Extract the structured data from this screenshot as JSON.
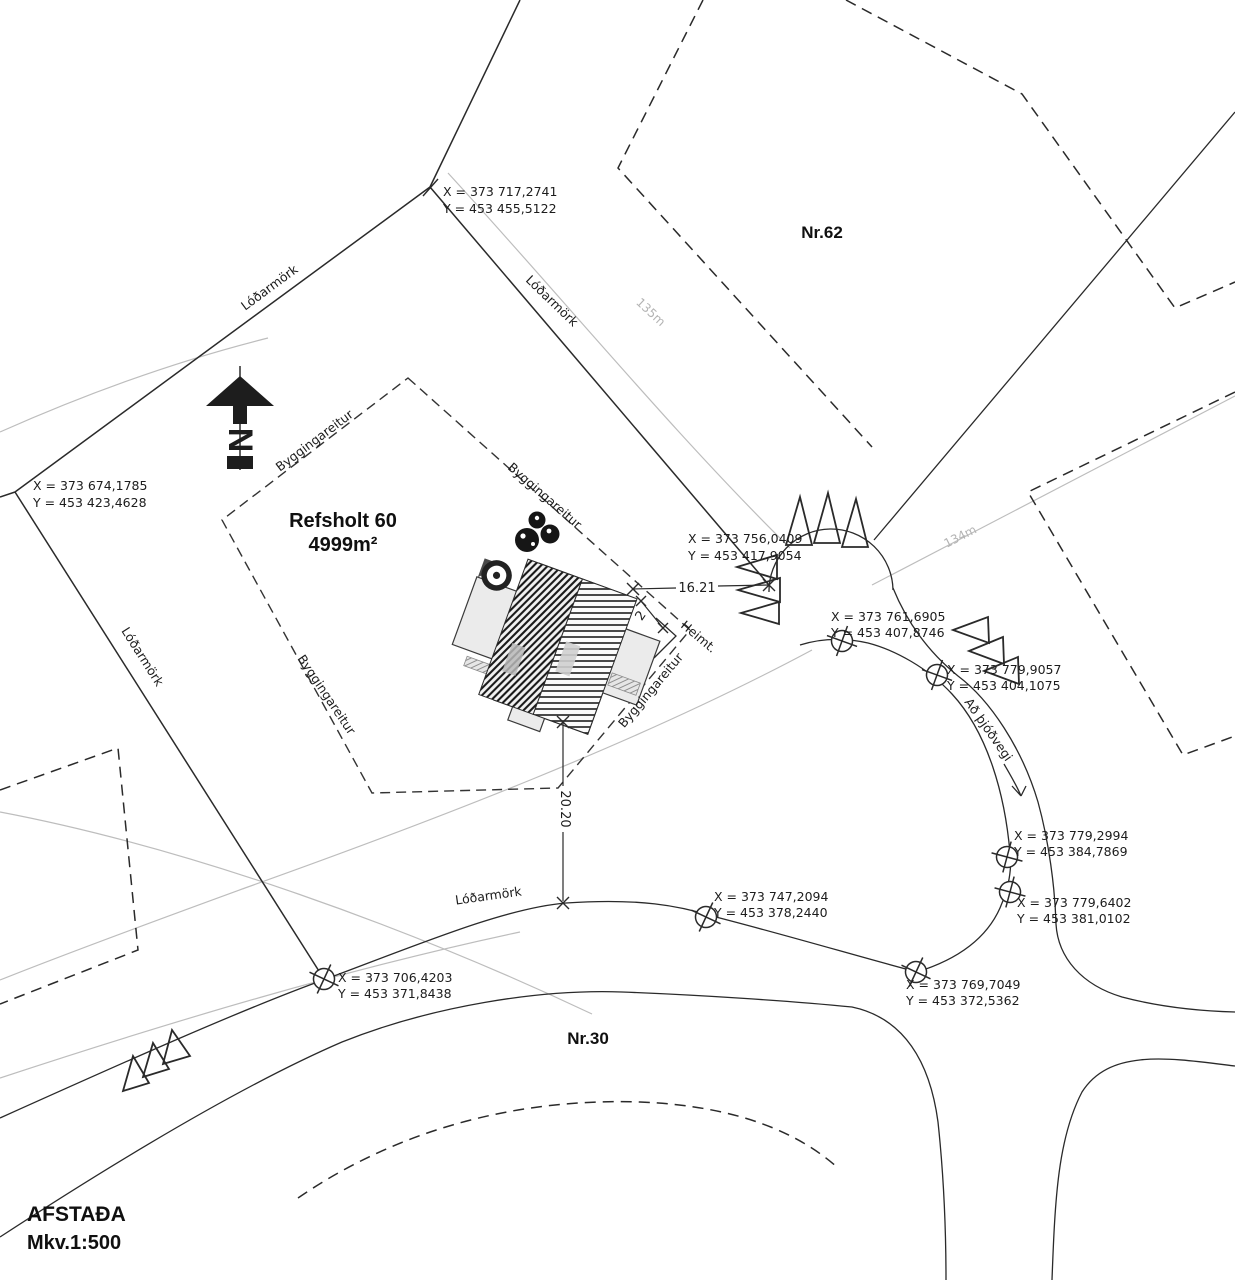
{
  "drawing": {
    "title": "AFSTAÐA",
    "scale": "Mkv.1:500",
    "north_label": "N"
  },
  "plot": {
    "name": "Refsholt 60",
    "area": "4999m²"
  },
  "neighbors": {
    "north_plot": "Nr.62",
    "south_plot": "Nr.30"
  },
  "labels": {
    "lodarmork": "Lóðarmörk",
    "byggingareitur": "Byggingareitur",
    "heimt": "Heimt.",
    "ad_thjodvegi": "Að þjóðvegi",
    "seg135": "135m",
    "seg134": "134m"
  },
  "dimensions": {
    "frontage": "16.21",
    "setback": "2",
    "depth": "20.20"
  },
  "points": [
    {
      "x": "X = 373 717,2741",
      "y": "Y = 453 455,5122"
    },
    {
      "x": "X = 373 674,1785",
      "y": "Y = 453 423,4628"
    },
    {
      "x": "X = 373 756,0409",
      "y": "Y = 453 417,9054"
    },
    {
      "x": "X = 373 761,6905",
      "y": "Y = 453 407,8746"
    },
    {
      "x": "X = 373 779,9057",
      "y": "Y = 453 404,1075"
    },
    {
      "x": "X = 373 779,2994",
      "y": "Y = 453 384,7869"
    },
    {
      "x": "X = 373 779,6402",
      "y": "Y = 453 381,0102"
    },
    {
      "x": "X = 373 747,2094",
      "y": "Y = 453 378,2440"
    },
    {
      "x": "X = 373 706,4203",
      "y": "Y = 453 371,8438"
    },
    {
      "x": "X = 373 769,7049",
      "y": "Y = 453 372,5362"
    }
  ],
  "colors": {
    "ink": "#2a2a2a",
    "gray_line": "#bdbdbd",
    "fill_light": "#ebebeb"
  }
}
